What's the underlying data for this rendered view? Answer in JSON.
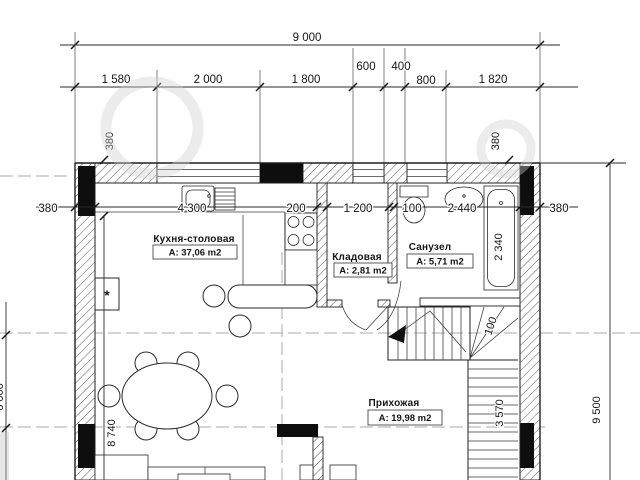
{
  "plan": {
    "top_dims": {
      "overall": "9 000",
      "row2": [
        "1 580",
        "2 000",
        "1 800",
        "600",
        "400",
        "800",
        "1 820"
      ]
    },
    "mid_dims": {
      "left_outside": "380",
      "row": [
        "4 300",
        "200",
        "1 200",
        "100",
        "2 440"
      ],
      "right_outside": "380"
    },
    "vert_dims": {
      "wall_left_top": "380",
      "wall_right_top": "380",
      "kitchen_depth": "8 740",
      "right_total": "9 500",
      "stair_flight": "3 570",
      "stair_note": "100",
      "bathtub": "2 340",
      "left_edge_partial": "6 000"
    },
    "rooms": {
      "kitchen": {
        "name": "Кухня-столовая",
        "area": "А: 37,06 m2"
      },
      "storage": {
        "name": "Кладовая",
        "area": "А: 2,81 m2"
      },
      "bathroom": {
        "name": "Санузел",
        "area": "А: 5,71 m2"
      },
      "hallway": {
        "name": "Прихожая",
        "area": "А: 19,98 m2"
      }
    },
    "appliance_mark": "*",
    "colors": {
      "line": "#1f1f1f",
      "pier": "#0e0e0e",
      "axis": "#aaaaaa",
      "paper": "#ffffff",
      "watermark": "#cfcfcf"
    }
  }
}
